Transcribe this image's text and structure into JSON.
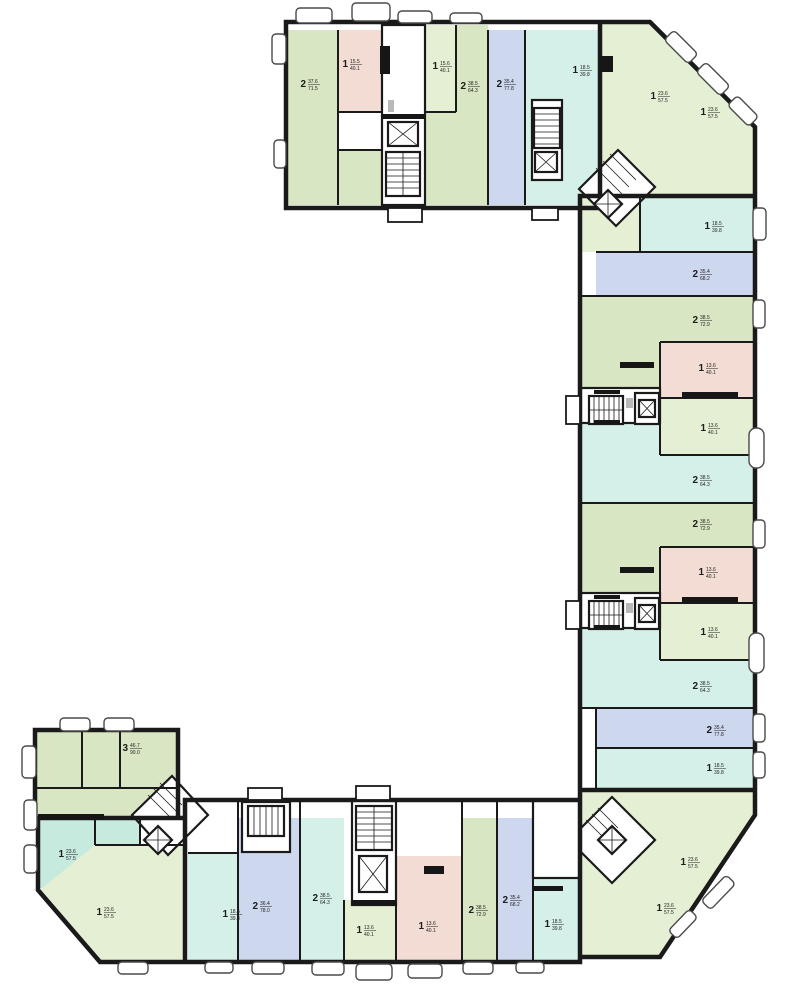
{
  "plan": {
    "background": "#ffffff",
    "wall_color": "#1a1a1a",
    "area_unit": "м²",
    "palette": {
      "green": "#d8e6c3",
      "green_light": "#e4efd4",
      "pink": "#f2dcd4",
      "blue": "#cdd8ee",
      "cyan": "#d5efe9",
      "teal": "#c6eade"
    },
    "units": [
      {
        "id": "u1",
        "rooms": "2",
        "living_area": "37.6",
        "total_area": "71.5",
        "color": "green",
        "x": 306,
        "y": 84
      },
      {
        "id": "u2",
        "rooms": "1",
        "living_area": "15.5",
        "total_area": "40.1",
        "color": "pink",
        "x": 348,
        "y": 64
      },
      {
        "id": "u3",
        "rooms": "1",
        "living_area": "15.6",
        "total_area": "40.1",
        "color": "green_light",
        "x": 438,
        "y": 66
      },
      {
        "id": "u4",
        "rooms": "2",
        "living_area": "38.5",
        "total_area": "64.3",
        "color": "green",
        "x": 466,
        "y": 86
      },
      {
        "id": "u5",
        "rooms": "2",
        "living_area": "35.4",
        "total_area": "77.8",
        "color": "blue",
        "x": 502,
        "y": 84
      },
      {
        "id": "u6",
        "rooms": "1",
        "living_area": "18.5",
        "total_area": "39.8",
        "color": "cyan",
        "x": 578,
        "y": 70
      },
      {
        "id": "u7",
        "rooms": "1",
        "living_area": "23.6",
        "total_area": "57.5",
        "color": "green_light",
        "x": 656,
        "y": 96
      },
      {
        "id": "u8",
        "rooms": "1",
        "living_area": "23.6",
        "total_area": "57.5",
        "color": "green_light",
        "x": 706,
        "y": 112
      },
      {
        "id": "u9",
        "rooms": "1",
        "living_area": "18.5",
        "total_area": "39.8",
        "color": "cyan",
        "x": 710,
        "y": 226
      },
      {
        "id": "u10",
        "rooms": "2",
        "living_area": "35.4",
        "total_area": "68.2",
        "color": "blue",
        "x": 698,
        "y": 274
      },
      {
        "id": "u11",
        "rooms": "2",
        "living_area": "38.5",
        "total_area": "72.9",
        "color": "green",
        "x": 698,
        "y": 320
      },
      {
        "id": "u12",
        "rooms": "1",
        "living_area": "13.6",
        "total_area": "40.1",
        "color": "pink",
        "x": 704,
        "y": 368
      },
      {
        "id": "u13",
        "rooms": "1",
        "living_area": "13.6",
        "total_area": "40.1",
        "color": "green_light",
        "x": 706,
        "y": 428
      },
      {
        "id": "u14",
        "rooms": "2",
        "living_area": "38.5",
        "total_area": "64.3",
        "color": "cyan",
        "x": 698,
        "y": 480
      },
      {
        "id": "u15",
        "rooms": "2",
        "living_area": "38.5",
        "total_area": "72.9",
        "color": "green",
        "x": 698,
        "y": 524
      },
      {
        "id": "u16",
        "rooms": "1",
        "living_area": "13.6",
        "total_area": "40.1",
        "color": "pink",
        "x": 704,
        "y": 572
      },
      {
        "id": "u17",
        "rooms": "1",
        "living_area": "13.6",
        "total_area": "40.1",
        "color": "green_light",
        "x": 706,
        "y": 632
      },
      {
        "id": "u18",
        "rooms": "2",
        "living_area": "38.5",
        "total_area": "64.3",
        "color": "cyan",
        "x": 698,
        "y": 686
      },
      {
        "id": "u19",
        "rooms": "2",
        "living_area": "35.4",
        "total_area": "77.8",
        "color": "blue",
        "x": 712,
        "y": 730
      },
      {
        "id": "u20",
        "rooms": "1",
        "living_area": "18.5",
        "total_area": "39.8",
        "color": "cyan",
        "x": 712,
        "y": 768
      },
      {
        "id": "u21",
        "rooms": "1",
        "living_area": "23.6",
        "total_area": "57.5",
        "color": "green_light",
        "x": 686,
        "y": 862
      },
      {
        "id": "u22",
        "rooms": "1",
        "living_area": "23.6",
        "total_area": "57.5",
        "color": "green_light",
        "x": 662,
        "y": 908
      },
      {
        "id": "u23",
        "rooms": "1",
        "living_area": "18.5",
        "total_area": "39.8",
        "color": "cyan",
        "x": 550,
        "y": 924
      },
      {
        "id": "u24",
        "rooms": "2",
        "living_area": "35.4",
        "total_area": "68.2",
        "color": "blue",
        "x": 508,
        "y": 900
      },
      {
        "id": "u25",
        "rooms": "2",
        "living_area": "38.5",
        "total_area": "72.9",
        "color": "green",
        "x": 474,
        "y": 910
      },
      {
        "id": "u26",
        "rooms": "1",
        "living_area": "13.6",
        "total_area": "40.1",
        "color": "pink",
        "x": 424,
        "y": 926
      },
      {
        "id": "u27",
        "rooms": "1",
        "living_area": "13.6",
        "total_area": "40.1",
        "color": "green_light",
        "x": 362,
        "y": 930
      },
      {
        "id": "u28",
        "rooms": "2",
        "living_area": "38.5",
        "total_area": "64.3",
        "color": "cyan",
        "x": 318,
        "y": 898
      },
      {
        "id": "u29",
        "rooms": "2",
        "living_area": "36.4",
        "total_area": "78.0",
        "color": "blue",
        "x": 258,
        "y": 906
      },
      {
        "id": "u30",
        "rooms": "1",
        "living_area": "18.5",
        "total_area": "39.8",
        "color": "cyan",
        "x": 228,
        "y": 914
      },
      {
        "id": "u31",
        "rooms": "3",
        "living_area": "46.7",
        "total_area": "90.0",
        "color": "green",
        "x": 128,
        "y": 748
      },
      {
        "id": "u32",
        "rooms": "1",
        "living_area": "23.6",
        "total_area": "57.5",
        "color": "teal",
        "x": 64,
        "y": 854
      },
      {
        "id": "u33",
        "rooms": "1",
        "living_area": "23.6",
        "total_area": "57.5",
        "color": "green_light",
        "x": 102,
        "y": 912
      }
    ]
  }
}
